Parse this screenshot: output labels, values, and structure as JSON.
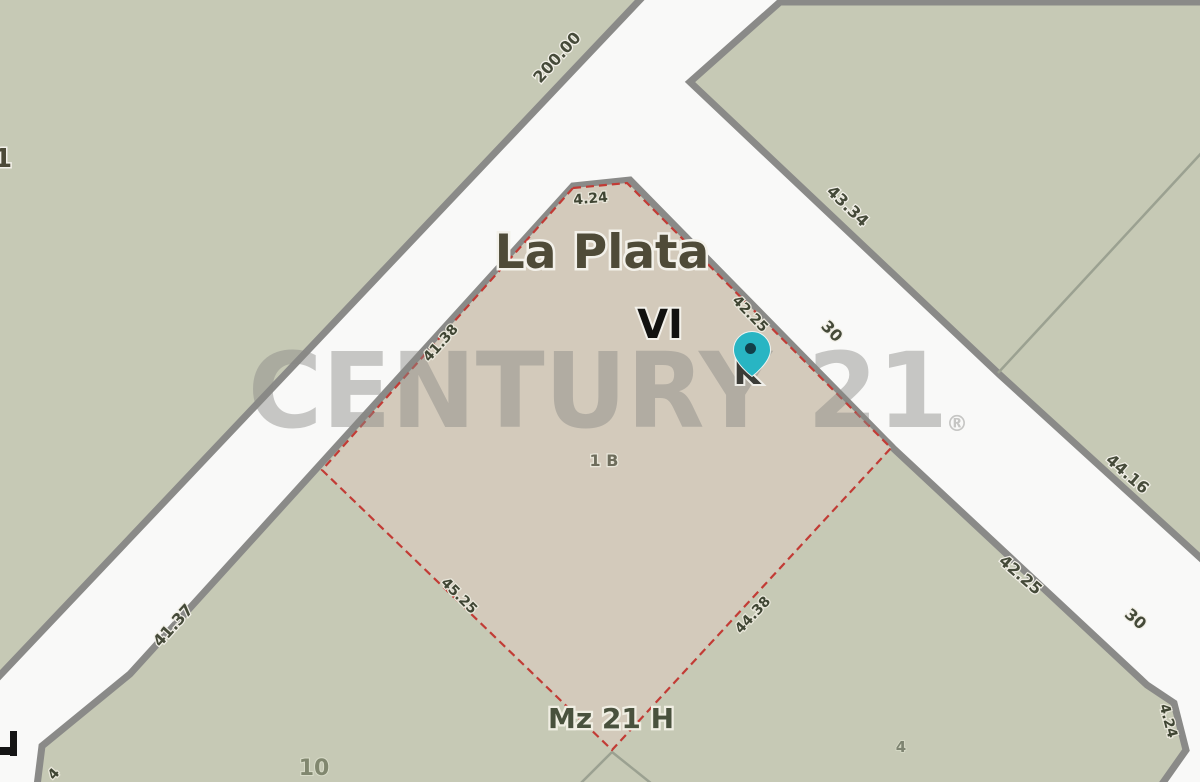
{
  "colors": {
    "road": "#f9f9f8",
    "block": "#c6c9b5",
    "parcel_fill": "#d3cabb",
    "parcel_border": "#c23b35",
    "block_border": "#8a8a88",
    "thin_line": "#9ba191",
    "pin": "#28b5c3",
    "pin_dot": "#123f49",
    "watermark": "rgba(136,136,132,0.45)"
  },
  "place": {
    "city": "La Plata",
    "zone": "VI",
    "block_letter": "K"
  },
  "parcel": {
    "lot": "1 B",
    "manzana": "Mz 21 H",
    "dim_top": "4.24",
    "dim_nw": "41.38",
    "dim_ne": "42.25",
    "dim_sw": "45.25",
    "dim_se": "44.38"
  },
  "neighbors": {
    "lot_sw": "10",
    "lot_se": "4",
    "edge_label_left": "1",
    "edge_label_bottom": "4"
  },
  "streets": {
    "frontage_top": "200.00",
    "frontage_sw": "41.37",
    "tr_block_a": "43.34",
    "tr_block_b": "44.16",
    "block_cont": "42.25",
    "street_a": "30",
    "street_b": "30",
    "corner_bevel": "4.24"
  },
  "watermark": {
    "text": "CENTURY 21",
    "registered": "®"
  }
}
